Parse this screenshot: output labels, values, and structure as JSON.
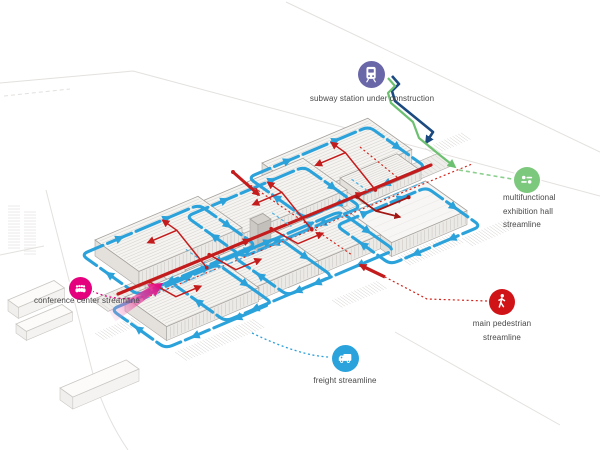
{
  "page": {
    "background": "#ffffff",
    "description": "isometric circulation diagram of an exhibition complex"
  },
  "legend": {
    "subway": {
      "label": "subway station under construction",
      "icon": "train-icon",
      "color": "#6A67A9"
    },
    "exhibition_hall": {
      "label": "multifunctional\nexhibition hall\nstreamline",
      "icon": "sliders-icon",
      "color": "#7CC87D"
    },
    "conference": {
      "label": "conference center streamline",
      "icon": "people-icon",
      "color": "#E5007D"
    },
    "pedestrian": {
      "label": "main pedestrian streamline",
      "icon": "pedestrian-icon",
      "color": "#D01317"
    },
    "freight": {
      "label": "freight streamline",
      "icon": "truck-icon",
      "color": "#2AA2DC"
    }
  },
  "streamlines": {
    "freight": {
      "color": "#2CA2DB"
    },
    "main_pedestrian": {
      "color": "#C41C1C"
    },
    "pedestrian_dotted": {
      "color": "#D2251B"
    },
    "conference": {
      "color": "#E5007D"
    },
    "exhibition": {
      "color": "#6CC070"
    },
    "exhibition_dashed": {
      "color": "#8BCF8C"
    },
    "subway": {
      "color": "#1B4A80"
    },
    "dark_red_loop": {
      "color": "#A21613"
    },
    "spine_dashed_blue": {
      "color": "#4FB2E2"
    }
  },
  "buildings": {
    "exhibition_halls_top_row": 3,
    "exhibition_halls_bottom_row": 3,
    "multifunctional_hall": 1,
    "annex_blocks": 1
  }
}
